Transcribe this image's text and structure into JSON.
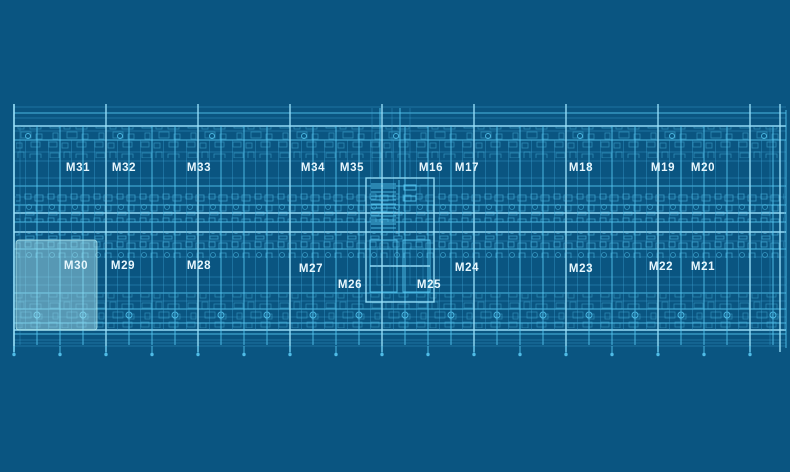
{
  "title": "Floor plan blueprint",
  "colors": {
    "background": "#0a5581",
    "line": "#56c8f2",
    "line_bright": "#9ae2fa",
    "line_dim": "#3aa0cf",
    "label": "#e8f7fd",
    "highlight": "#b5ecf2"
  },
  "plan": {
    "top_rooms": [
      "M31",
      "M32",
      "M33",
      "M34",
      "M35",
      "M16",
      "M17",
      "M18",
      "M19",
      "M20"
    ],
    "bottom_rooms": [
      "M30",
      "M29",
      "M28",
      "M27",
      "M26",
      "M25",
      "M24",
      "M23",
      "M22",
      "M21"
    ],
    "selected_room": "M30"
  }
}
